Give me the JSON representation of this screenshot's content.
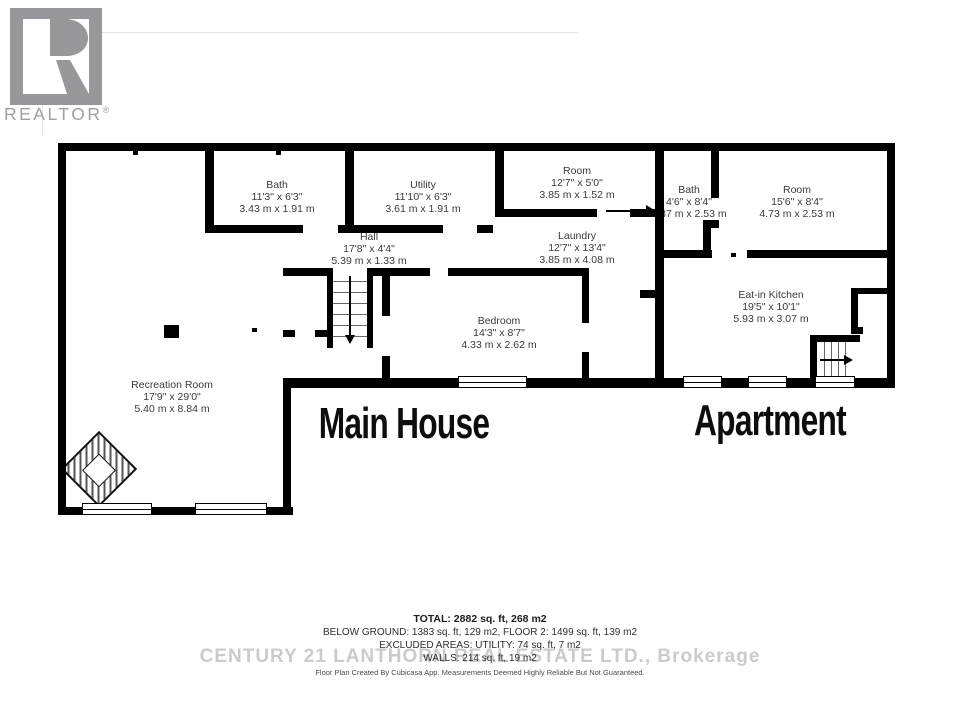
{
  "logo": {
    "realtor_label": "REALTOR",
    "registered_mark": "®"
  },
  "plan": {
    "rooms": [
      {
        "id": "bath-main",
        "name": "Bath",
        "imperial": "11'3\" x 6'3\"",
        "metric": "3.43 m x 1.91 m"
      },
      {
        "id": "utility",
        "name": "Utility",
        "imperial": "11'10\" x 6'3\"",
        "metric": "3.61 m x 1.91 m"
      },
      {
        "id": "hall",
        "name": "Hall",
        "imperial": "17'8\" x 4'4\"",
        "metric": "5.39 m x 1.33 m"
      },
      {
        "id": "room-main",
        "name": "Room",
        "imperial": "12'7\" x 5'0\"",
        "metric": "3.85 m x 1.52 m"
      },
      {
        "id": "laundry",
        "name": "Laundry",
        "imperial": "12'7\" x 13'4\"",
        "metric": "3.85 m x 4.08 m"
      },
      {
        "id": "bedroom",
        "name": "Bedroom",
        "imperial": "14'3\" x 8'7\"",
        "metric": "4.33 m x 2.62 m"
      },
      {
        "id": "recreation-room",
        "name": "Recreation Room",
        "imperial": "17'9\" x 29'0\"",
        "metric": "5.40 m x 8.84 m"
      },
      {
        "id": "bath-apartment",
        "name": "Bath",
        "imperial": "4'6\" x 8'4\"",
        "metric": "1.37 m x 2.53 m"
      },
      {
        "id": "room-apartment",
        "name": "Room",
        "imperial": "15'6\" x 8'4\"",
        "metric": "4.73 m x 2.53 m"
      },
      {
        "id": "eat-in-kitchen",
        "name": "Eat-in Kitchen",
        "imperial": "19'5\" x 10'1\"",
        "metric": "5.93 m x 3.07 m"
      }
    ],
    "sections": {
      "main_house": "Main House",
      "apartment": "Apartment"
    }
  },
  "footer": {
    "total": "TOTAL: 2882 sq. ft, 268 m2",
    "below_ground": "BELOW GROUND: 1383 sq. ft, 129 m2, FLOOR 2: 1499 sq. ft, 139 m2",
    "excluded": "EXCLUDED AREAS: UTILITY: 74 sq. ft, 7 m2",
    "walls": "WALLS: 214 sq. ft, 19 m2",
    "brokerage_watermark": "CENTURY 21 LANTHORN REAL ESTATE LTD., Brokerage",
    "disclaimer": "Floor Plan Created By Cubicasa App. Measurements Deemed Highly Reliable But Not Guaranteed."
  },
  "colors": {
    "wall": "#000000",
    "label_text": "#3a3a3a",
    "logo_gray": "#98989c",
    "watermark_gray": "#cbcbcb"
  }
}
